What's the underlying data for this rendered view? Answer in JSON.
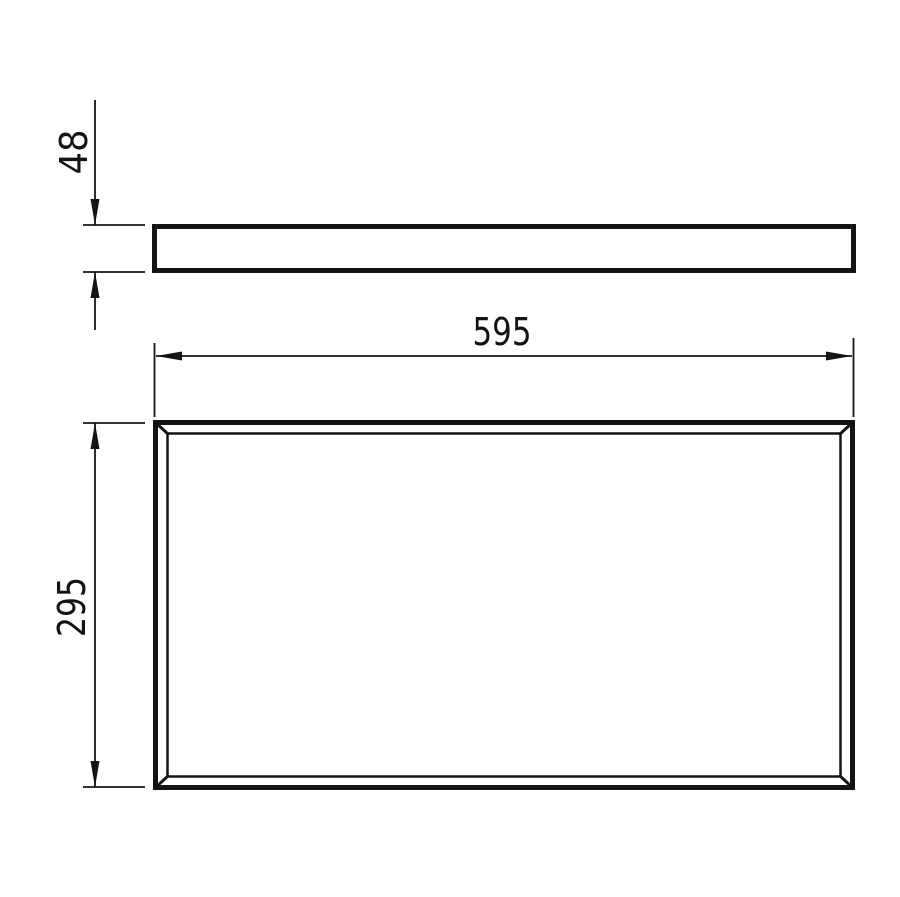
{
  "drawing": {
    "type": "technical-dimension-drawing",
    "views": {
      "side_view_name": "panel-side-profile",
      "front_view_name": "panel-front-face"
    },
    "dimensions": {
      "width_label": "595",
      "height_label": "295",
      "thickness_label": "48"
    },
    "colors": {
      "line": "#141414",
      "background": "#ffffff"
    }
  }
}
